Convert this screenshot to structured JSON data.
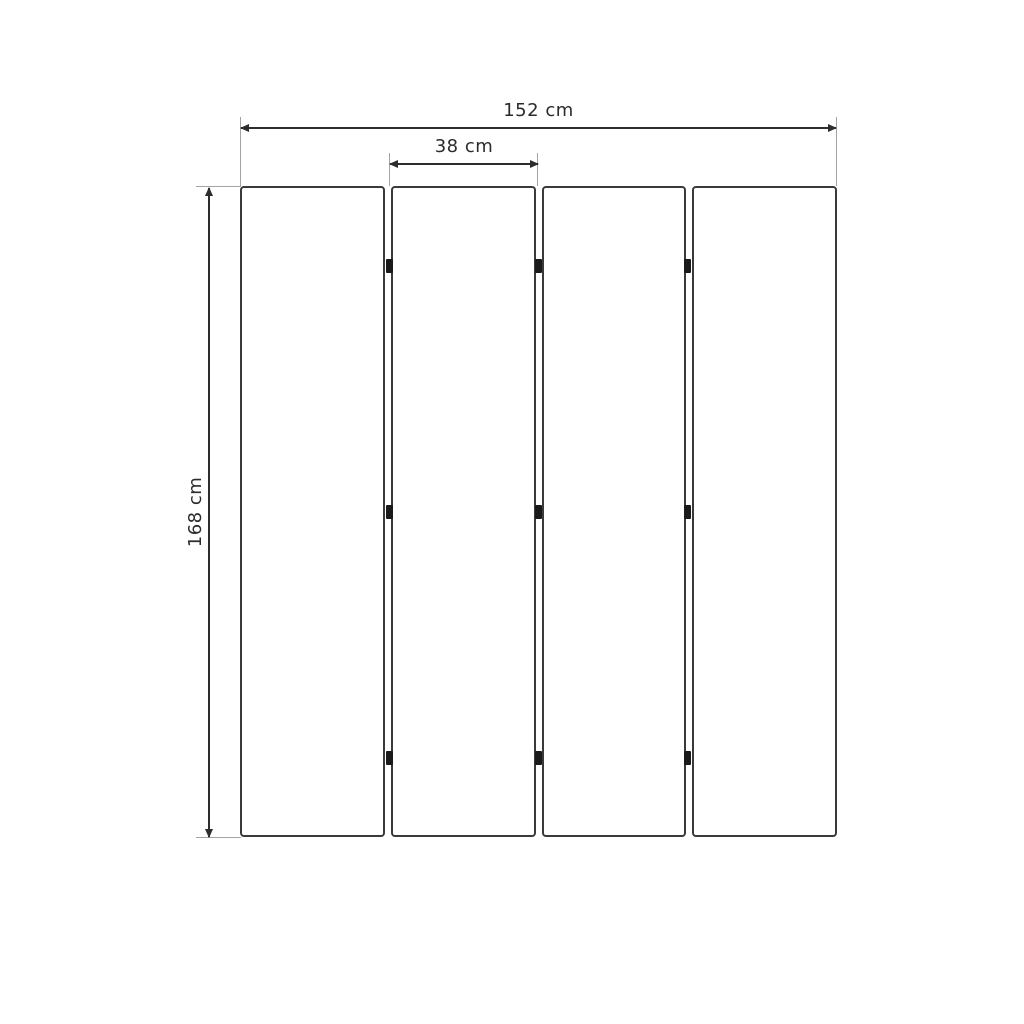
{
  "diagram": {
    "panel_count": 4,
    "hinge_rows": 3,
    "dimensions": {
      "total_width": "152 cm",
      "panel_width": "38 cm",
      "height": "168 cm"
    },
    "colors": {
      "background": "#ffffff",
      "panel_border": "#3a3a3a",
      "dimension_line": "#2d2d2d",
      "extension_line": "#a3a3a3",
      "hinge": "#1a1a1a",
      "label_text": "#2b2b2b"
    }
  }
}
